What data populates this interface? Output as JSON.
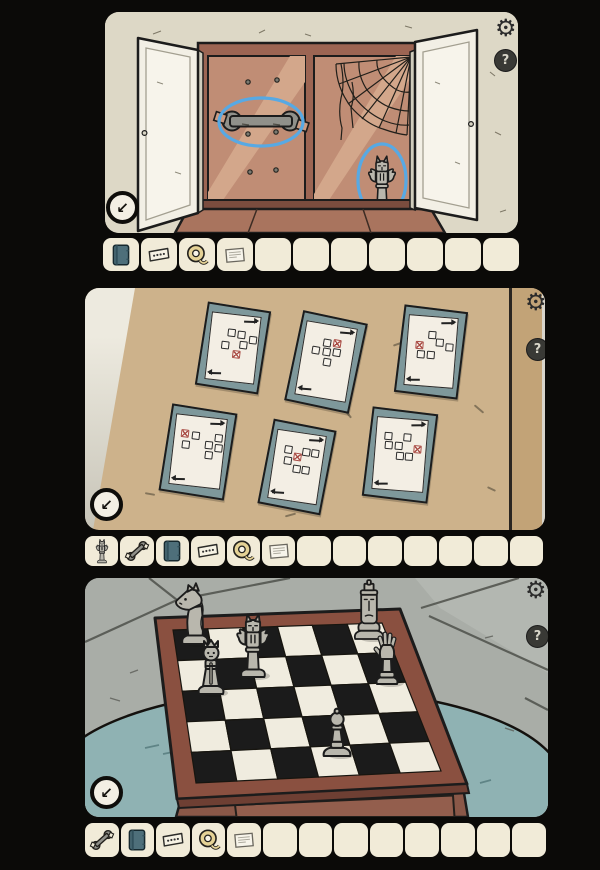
{
  "colors": {
    "page_bg": "#0b0a08",
    "panel_wall": "#ddd8c6",
    "slot_bg": "#f1ebd8",
    "highlight_blue": "#57a9e4",
    "frame_teal": "#7e989b",
    "paper": "#f3eee4",
    "red_mark": "#a94b44",
    "wall_tan": "#cdb28b",
    "cabinet_frame": "#9c6553",
    "cabinet_back": "#c08d75",
    "door_white": "#f2efe5",
    "board_dark": "#1b1b1b",
    "board_light": "#f0ecdf",
    "board_frame": "#8a5040",
    "table_front": "#8a5848",
    "rug_teal": "#8fb2b3",
    "floor_gray": "#a9ada7",
    "piece_gray": "#b9b7ad"
  },
  "hud": {
    "settings_icon": "⚙",
    "help_icon": "?",
    "exit_icon": "↙"
  },
  "panels": [
    {
      "name": "cupboard",
      "highlights": [
        "wrench",
        "chess-piece"
      ],
      "inventory": {
        "slot_count": 11,
        "items": [
          "notebook",
          "ticket",
          "measuring-tape",
          "note"
        ]
      }
    },
    {
      "name": "picture-wall",
      "inventory": {
        "slot_count": 13,
        "items": [
          "chess-piece",
          "wrench",
          "notebook",
          "ticket",
          "measuring-tape",
          "note"
        ]
      },
      "frames": [
        {
          "cx": 148,
          "cy": 60,
          "w": 64,
          "h": 84,
          "rot": 9,
          "cells": [
            [
              1,
              0,
              0
            ],
            [
              2,
              0.1,
              0
            ],
            [
              3.1,
              0.5,
              0
            ],
            [
              2.3,
              1,
              0
            ],
            [
              0.6,
              1.2,
              0
            ],
            [
              1.7,
              2,
              1
            ]
          ]
        },
        {
          "cx": 241,
          "cy": 74,
          "w": 66,
          "h": 92,
          "rot": 12,
          "cells": [
            [
              1.2,
              0,
              0
            ],
            [
              2.2,
              -0.1,
              1
            ],
            [
              0.3,
              0.9,
              0
            ],
            [
              1.3,
              0.9,
              0
            ],
            [
              2.3,
              0.8,
              0
            ],
            [
              1.5,
              1.8,
              0
            ]
          ]
        },
        {
          "cx": 346,
          "cy": 64,
          "w": 64,
          "h": 88,
          "rot": 7,
          "cells": [
            [
              1.3,
              0,
              0
            ],
            [
              2.1,
              0.7,
              0
            ],
            [
              3,
              1,
              0
            ],
            [
              0.2,
              1,
              1
            ],
            [
              0.4,
              1.9,
              0
            ],
            [
              1.3,
              1.9,
              0
            ]
          ]
        },
        {
          "cx": 113,
          "cy": 164,
          "w": 66,
          "h": 88,
          "rot": 9,
          "cells": [
            [
              0,
              0,
              1
            ],
            [
              1,
              0.05,
              0
            ],
            [
              3.2,
              0.1,
              0
            ],
            [
              0.2,
              1,
              0
            ],
            [
              2.4,
              0.9,
              0
            ],
            [
              3.3,
              1,
              0
            ],
            [
              2.5,
              1.8,
              0
            ]
          ]
        },
        {
          "cx": 212,
          "cy": 179,
          "w": 64,
          "h": 86,
          "rot": 11,
          "cells": [
            [
              0.3,
              0,
              0
            ],
            [
              2,
              0,
              0
            ],
            [
              2.9,
              0,
              0
            ],
            [
              1.2,
              0.6,
              1
            ],
            [
              0.4,
              1,
              0
            ],
            [
              1.3,
              1.7,
              0
            ],
            [
              2.2,
              1.7,
              0
            ]
          ]
        },
        {
          "cx": 315,
          "cy": 167,
          "w": 66,
          "h": 90,
          "rot": 7,
          "cells": [
            [
              0.2,
              0,
              0
            ],
            [
              2,
              0,
              0
            ],
            [
              0.3,
              0.9,
              0
            ],
            [
              1.2,
              0.9,
              0
            ],
            [
              3,
              1,
              1
            ],
            [
              1.4,
              1.8,
              0
            ],
            [
              2.3,
              1.8,
              0
            ]
          ]
        }
      ]
    },
    {
      "name": "chessboard",
      "inventory": {
        "slot_count": 13,
        "items": [
          "wrench",
          "notebook",
          "ticket",
          "measuring-tape",
          "note"
        ]
      },
      "board": {
        "cols": 6,
        "rows": 5
      },
      "pieces": [
        {
          "type": "knight",
          "x": 110,
          "y": 66
        },
        {
          "type": "gargoyle",
          "x": 168,
          "y": 99
        },
        {
          "type": "king",
          "x": 284,
          "y": 61
        },
        {
          "type": "queen",
          "x": 126,
          "y": 116
        },
        {
          "type": "hand",
          "x": 302,
          "y": 106
        },
        {
          "type": "pawn",
          "x": 252,
          "y": 178
        }
      ]
    }
  ]
}
